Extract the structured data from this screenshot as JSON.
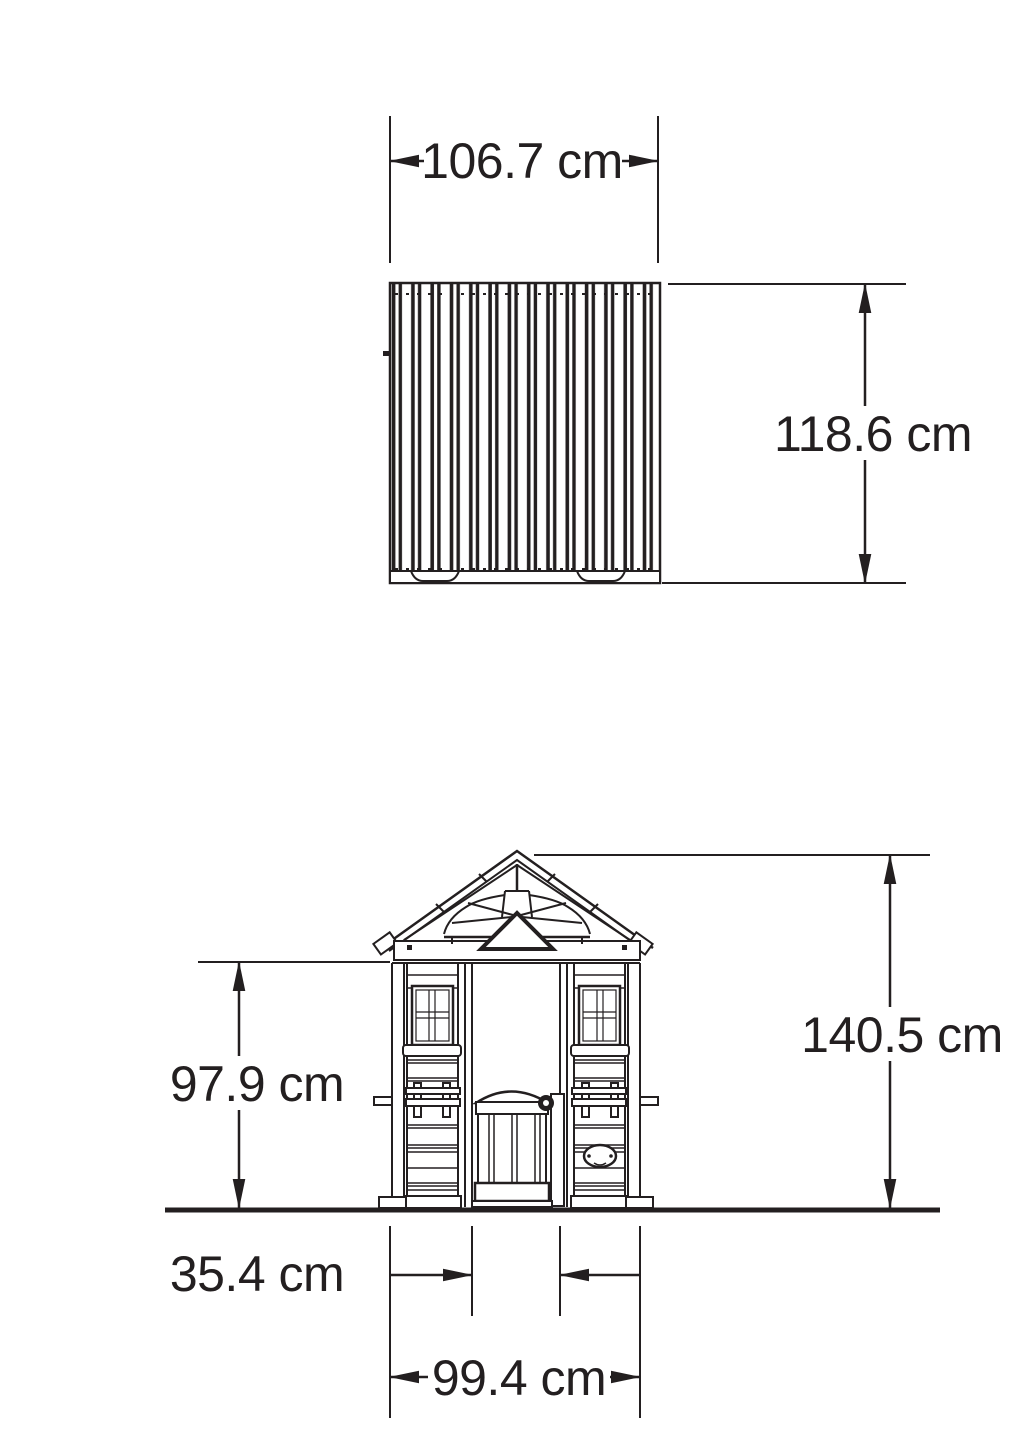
{
  "colors": {
    "ink": "#231f20",
    "background": "#ffffff"
  },
  "unit": "cm",
  "top_view": {
    "width_label": "106.7 cm",
    "width_value": 106.7,
    "depth_label": "118.6 cm",
    "depth_value": 118.6
  },
  "front_view": {
    "wall_height_label": "97.9 cm",
    "wall_height_value": 97.9,
    "total_height_label": "140.5 cm",
    "total_height_value": 140.5,
    "door_width_label": "35.4 cm",
    "door_width_value": 35.4,
    "base_width_label": "99.4 cm",
    "base_width_value": 99.4
  }
}
